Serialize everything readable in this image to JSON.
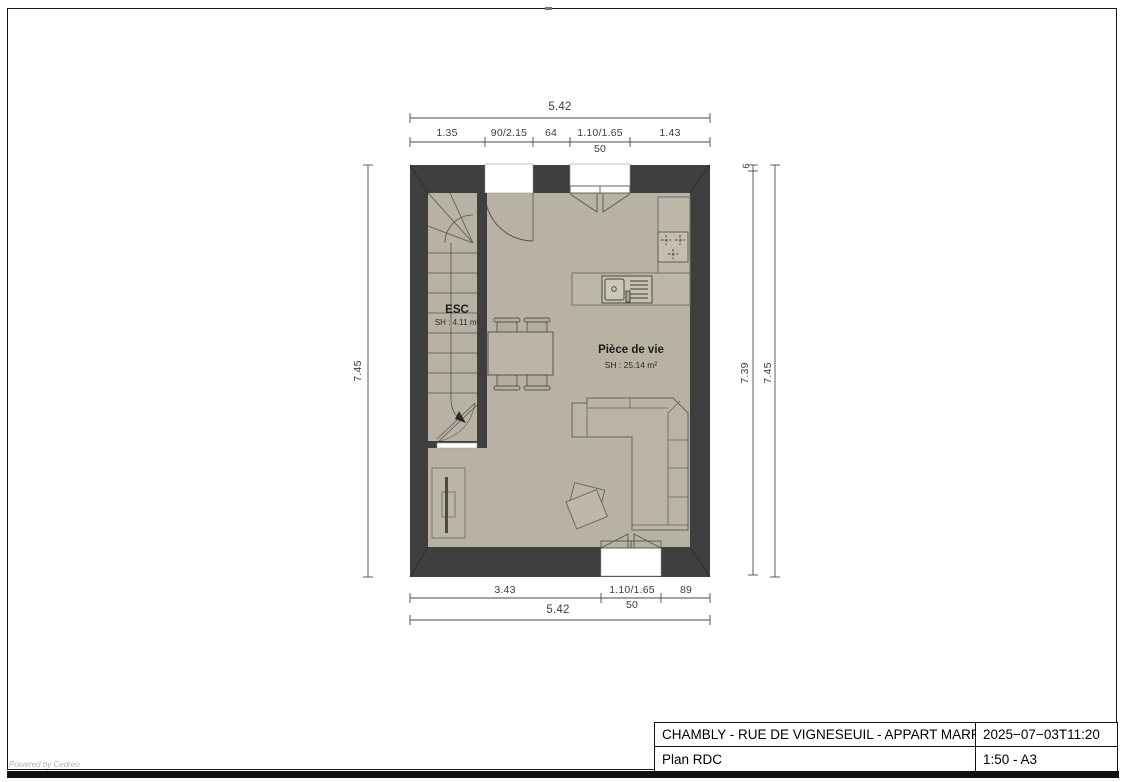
{
  "title_block": {
    "project": "CHAMBLY - RUE DE VIGNESEUIL - APPART MARRON",
    "date": "2025−07−03T11:20",
    "plan_name": "Plan RDC",
    "scale_format": "1:50 - A3"
  },
  "rooms": {
    "staircase": {
      "name": "ESC",
      "area": "SH : 4.11 m²"
    },
    "living_room": {
      "name": "Pièce de vie",
      "area": "SH : 25.14 m²"
    }
  },
  "dimensions": {
    "top": {
      "total": "5.42",
      "segments": [
        "1.35",
        "90/2.15",
        "64",
        "1.10/1.65",
        "1.43"
      ],
      "sub": "50"
    },
    "bottom": {
      "total": "5.42",
      "segments": [
        "3.43",
        "1.10/1.65",
        "89"
      ],
      "sub": "50"
    },
    "left": {
      "total": "7.45"
    },
    "right": {
      "top_offset": "6",
      "inner": "7.39",
      "outer": "7.45"
    }
  },
  "footer": {
    "powered_by": "Powered by Cedreo"
  },
  "colors": {
    "wall": "#3f3f3f",
    "floor": "#b7b2a3",
    "counter": "#bcb7a8",
    "line": "#55554e",
    "dim": "#3d3d3d"
  }
}
